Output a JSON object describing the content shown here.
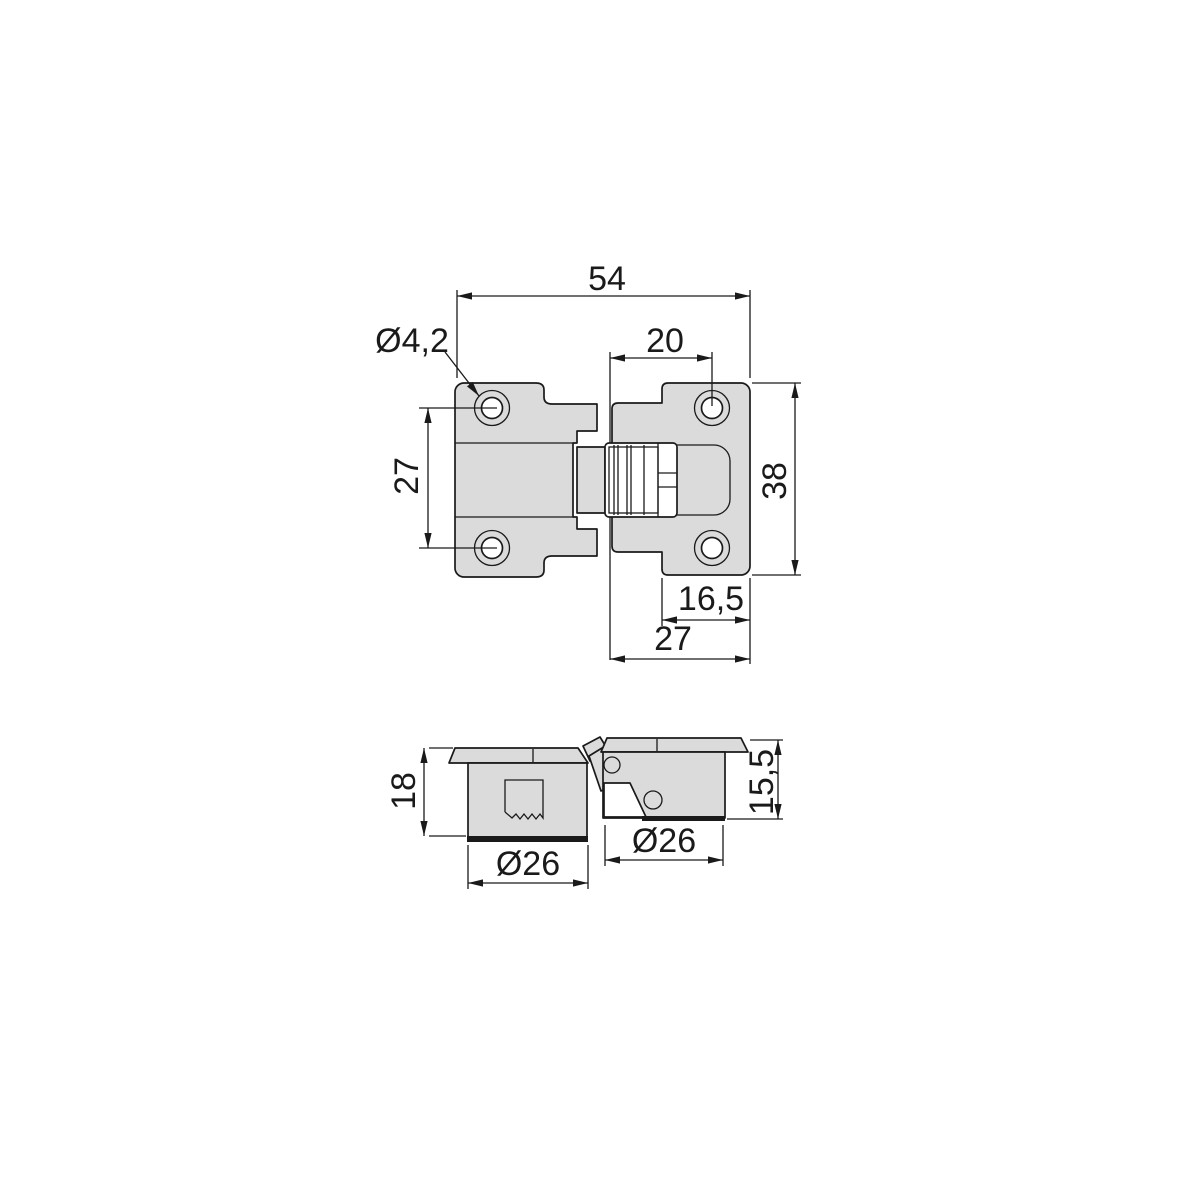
{
  "colors": {
    "background": "#ffffff",
    "part_fill": "#dbdbdb",
    "line": "#1a1a1a"
  },
  "dims": {
    "overall_width": "54",
    "screw_hole_dia": "Ø4,2",
    "hole_offset": "20",
    "hole_spacing": "27",
    "plate_height": "38",
    "hole_edge_offset": "16,5",
    "right_plate_width": "27",
    "left_cup_depth": "18",
    "left_cup_dia": "Ø26",
    "right_cup_dia": "Ø26",
    "right_cup_depth": "15,5"
  }
}
